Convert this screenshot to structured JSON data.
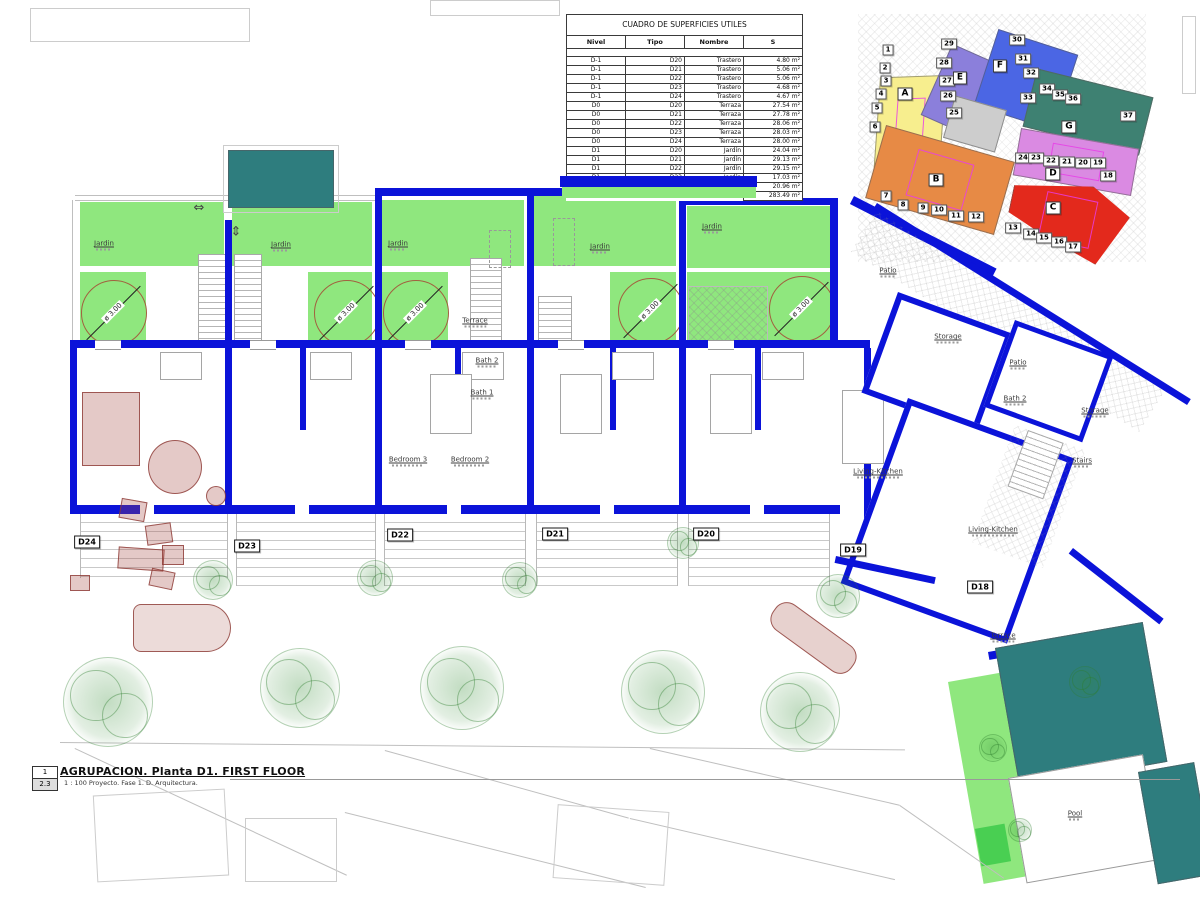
{
  "title_block": {
    "sheet_number": "1",
    "detail_number": "2.3",
    "title": "AGRUPACION. Planta D1. FIRST FLOOR",
    "subtitle": "1 : 100 Proyecto. Fase 1. D. Arquitectura."
  },
  "surface_table": {
    "title": "CUADRO DE SUPERFICIES UTILES",
    "headers": [
      "Nivel",
      "Tipo",
      "Nombre",
      "S"
    ],
    "rows": [
      [
        "D-1",
        "D20",
        "Trastero",
        "4.80 m²"
      ],
      [
        "D-1",
        "D21",
        "Trastero",
        "5.06 m²"
      ],
      [
        "D-1",
        "D22",
        "Trastero",
        "5.06 m²"
      ],
      [
        "D-1",
        "D23",
        "Trastero",
        "4.68 m²"
      ],
      [
        "D-1",
        "D24",
        "Trastero",
        "4.67 m²"
      ],
      [
        "D0",
        "D20",
        "Terraza",
        "27.54 m²"
      ],
      [
        "D0",
        "D21",
        "Terraza",
        "27.78 m²"
      ],
      [
        "D0",
        "D22",
        "Terraza",
        "28.06 m²"
      ],
      [
        "D0",
        "D23",
        "Terraza",
        "28.03 m²"
      ],
      [
        "D0",
        "D24",
        "Terraza",
        "28.00 m²"
      ],
      [
        "D1",
        "D20",
        "Jardín",
        "24.04 m²"
      ],
      [
        "D1",
        "D21",
        "Jardín",
        "29.13 m²"
      ],
      [
        "D1",
        "D22",
        "Jardín",
        "29.15 m²"
      ],
      [
        "D1",
        "D23",
        "Jardín",
        "17.03 m²"
      ],
      [
        "D1",
        "D24",
        "Jardín",
        "20.96 m²"
      ]
    ],
    "total": "283.49 m²"
  },
  "key_plan": {
    "letters": [
      {
        "t": "A",
        "x": 905,
        "y": 94
      },
      {
        "t": "E",
        "x": 960,
        "y": 78
      },
      {
        "t": "F",
        "x": 1000,
        "y": 66
      },
      {
        "t": "G",
        "x": 1069,
        "y": 127
      },
      {
        "t": "B",
        "x": 936,
        "y": 180
      },
      {
        "t": "D",
        "x": 1053,
        "y": 174
      },
      {
        "t": "C",
        "x": 1053,
        "y": 208
      }
    ],
    "numbers": [
      {
        "t": "1",
        "x": 888,
        "y": 50
      },
      {
        "t": "2",
        "x": 885,
        "y": 68
      },
      {
        "t": "3",
        "x": 886,
        "y": 81
      },
      {
        "t": "4",
        "x": 881,
        "y": 94
      },
      {
        "t": "5",
        "x": 877,
        "y": 108
      },
      {
        "t": "6",
        "x": 875,
        "y": 127
      },
      {
        "t": "29",
        "x": 949,
        "y": 44
      },
      {
        "t": "28",
        "x": 944,
        "y": 63
      },
      {
        "t": "27",
        "x": 947,
        "y": 81
      },
      {
        "t": "26",
        "x": 948,
        "y": 96
      },
      {
        "t": "25",
        "x": 954,
        "y": 113
      },
      {
        "t": "30",
        "x": 1017,
        "y": 40
      },
      {
        "t": "31",
        "x": 1023,
        "y": 59
      },
      {
        "t": "32",
        "x": 1031,
        "y": 73
      },
      {
        "t": "33",
        "x": 1028,
        "y": 98
      },
      {
        "t": "34",
        "x": 1047,
        "y": 89
      },
      {
        "t": "35",
        "x": 1060,
        "y": 95
      },
      {
        "t": "36",
        "x": 1073,
        "y": 99
      },
      {
        "t": "37",
        "x": 1128,
        "y": 116
      },
      {
        "t": "24",
        "x": 1023,
        "y": 158
      },
      {
        "t": "23",
        "x": 1036,
        "y": 158
      },
      {
        "t": "22",
        "x": 1051,
        "y": 161
      },
      {
        "t": "21",
        "x": 1067,
        "y": 162
      },
      {
        "t": "20",
        "x": 1083,
        "y": 163
      },
      {
        "t": "19",
        "x": 1098,
        "y": 163
      },
      {
        "t": "18",
        "x": 1108,
        "y": 176
      },
      {
        "t": "7",
        "x": 886,
        "y": 196
      },
      {
        "t": "8",
        "x": 903,
        "y": 205
      },
      {
        "t": "9",
        "x": 923,
        "y": 208
      },
      {
        "t": "10",
        "x": 939,
        "y": 210
      },
      {
        "t": "11",
        "x": 956,
        "y": 216
      },
      {
        "t": "12",
        "x": 976,
        "y": 217
      },
      {
        "t": "13",
        "x": 1013,
        "y": 228
      },
      {
        "t": "14",
        "x": 1031,
        "y": 234
      },
      {
        "t": "15",
        "x": 1044,
        "y": 238
      },
      {
        "t": "16",
        "x": 1059,
        "y": 242
      },
      {
        "t": "17",
        "x": 1073,
        "y": 247
      }
    ]
  },
  "floor_plan": {
    "room_labels": [
      {
        "t": "Jardin",
        "x": 104,
        "y": 245
      },
      {
        "t": "Jardin",
        "x": 281,
        "y": 246
      },
      {
        "t": "Jardin",
        "x": 398,
        "y": 245
      },
      {
        "t": "Jardin",
        "x": 600,
        "y": 248
      },
      {
        "t": "Jardin",
        "x": 712,
        "y": 228
      },
      {
        "t": "Terrace",
        "x": 475,
        "y": 322
      },
      {
        "t": "Bath 2",
        "x": 487,
        "y": 362
      },
      {
        "t": "Bath 1",
        "x": 482,
        "y": 394
      },
      {
        "t": "Bedroom 3",
        "x": 408,
        "y": 461
      },
      {
        "t": "Bedroom 2",
        "x": 470,
        "y": 461
      },
      {
        "t": "Patio",
        "x": 888,
        "y": 272
      },
      {
        "t": "Storage",
        "x": 948,
        "y": 338
      },
      {
        "t": "Patio",
        "x": 1018,
        "y": 364
      },
      {
        "t": "Bath 2",
        "x": 1015,
        "y": 400
      },
      {
        "t": "Storage",
        "x": 1095,
        "y": 412
      },
      {
        "t": "Living-Kitchen",
        "x": 878,
        "y": 473
      },
      {
        "t": "Stairs",
        "x": 1082,
        "y": 462
      },
      {
        "t": "Living-Kitchen",
        "x": 993,
        "y": 531
      },
      {
        "t": "Terrace",
        "x": 1003,
        "y": 637
      },
      {
        "t": "Pool",
        "x": 1075,
        "y": 815
      }
    ],
    "dim_labels": [
      {
        "t": "ø 3.00",
        "x": 113,
        "y": 312
      },
      {
        "t": "ø 3.00",
        "x": 346,
        "y": 312
      },
      {
        "t": "ø 3.00",
        "x": 415,
        "y": 312
      },
      {
        "t": "ø 3.00",
        "x": 650,
        "y": 310
      },
      {
        "t": "ø 3.00",
        "x": 801,
        "y": 308
      }
    ],
    "unit_tags": [
      {
        "t": "D24",
        "x": 87,
        "y": 542
      },
      {
        "t": "D23",
        "x": 247,
        "y": 546
      },
      {
        "t": "D22",
        "x": 400,
        "y": 535
      },
      {
        "t": "D21",
        "x": 555,
        "y": 534
      },
      {
        "t": "D20",
        "x": 706,
        "y": 534
      },
      {
        "t": "D19",
        "x": 853,
        "y": 550
      },
      {
        "t": "D18",
        "x": 980,
        "y": 587
      }
    ],
    "stair_arrows": [
      {
        "t": "⇔",
        "x": 199,
        "y": 208
      },
      {
        "t": "⇕",
        "x": 236,
        "y": 232
      }
    ],
    "trees": [
      {
        "x": 108,
        "y": 702,
        "r": 45
      },
      {
        "x": 300,
        "y": 688,
        "r": 40
      },
      {
        "x": 462,
        "y": 688,
        "r": 42
      },
      {
        "x": 663,
        "y": 692,
        "r": 42
      },
      {
        "x": 800,
        "y": 712,
        "r": 40
      },
      {
        "x": 213,
        "y": 580,
        "r": 20
      },
      {
        "x": 375,
        "y": 578,
        "r": 18
      },
      {
        "x": 520,
        "y": 580,
        "r": 18
      },
      {
        "x": 683,
        "y": 543,
        "r": 16
      },
      {
        "x": 838,
        "y": 596,
        "r": 22
      },
      {
        "x": 993,
        "y": 748,
        "r": 14
      },
      {
        "x": 1085,
        "y": 682,
        "r": 16
      },
      {
        "x": 1020,
        "y": 830,
        "r": 12
      }
    ]
  },
  "colors": {
    "wall_blue": "#0b13d9",
    "garden_green": "#8fe77e",
    "pool_teal": "#2e7d7e",
    "key_yellow": "#f7ee8e",
    "key_purple": "#8b7fdb",
    "key_blue": "#4b66e4",
    "key_teal": "#3e8172",
    "key_violet": "#da8ae2",
    "key_orange": "#e78a45",
    "key_red": "#e3291c",
    "key_gray": "#cdcdcd",
    "circle_brown": "#a2603f",
    "furniture_red": "#a54b46",
    "tree_green": "#348c34"
  }
}
